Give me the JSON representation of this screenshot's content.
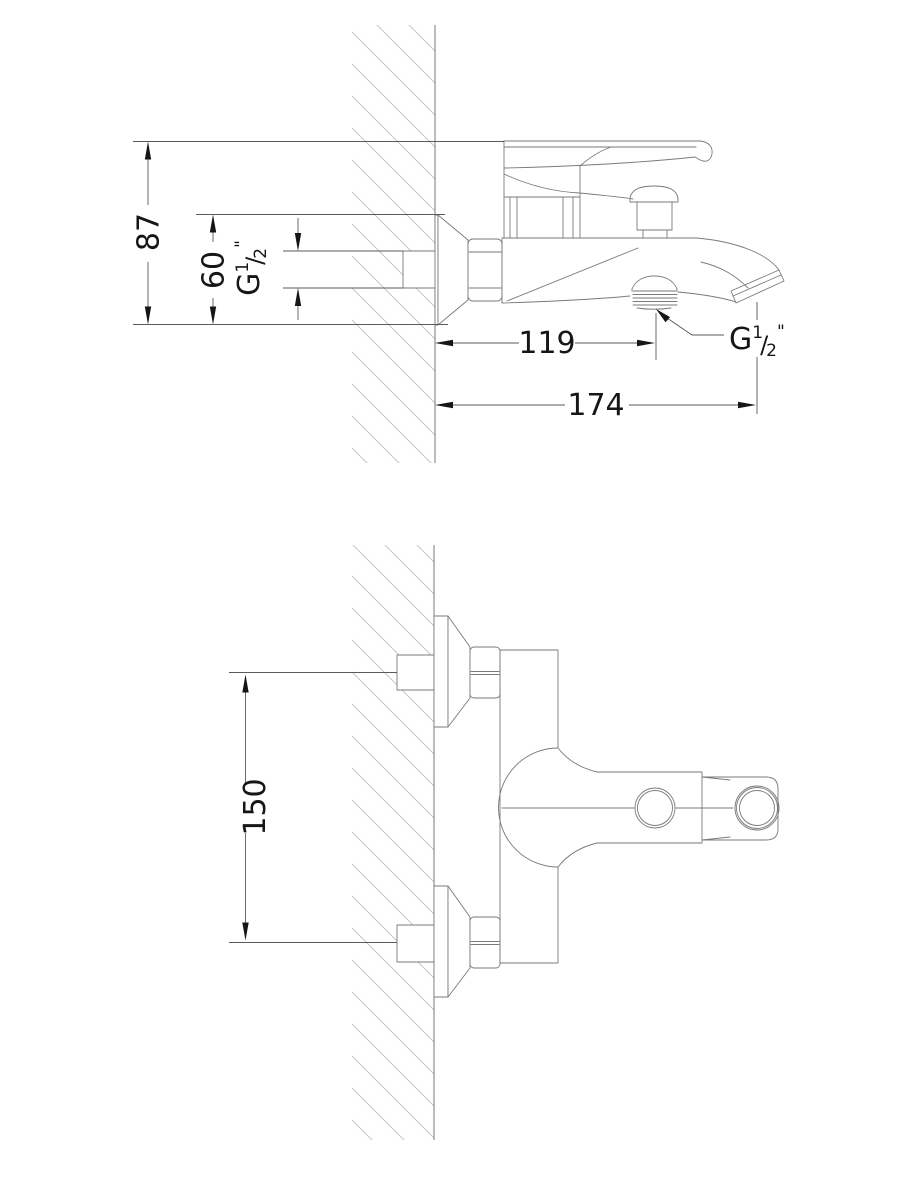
{
  "colors": {
    "bg": "#ffffff",
    "line": "#7a7a7a",
    "dim": "#5a5a5a",
    "hatch": "#c6c6c6",
    "text": "#161616"
  },
  "views": {
    "side_view": {
      "dims": {
        "height_87": "87",
        "height_60": "60",
        "offset_119": "119",
        "reach_174": "174"
      }
    },
    "front_view": {
      "dims": {
        "spacing_150": "150"
      }
    }
  },
  "thread": {
    "prefix": "G",
    "numerator": "1",
    "slash": "/",
    "denominator": "2",
    "inch": "\""
  }
}
